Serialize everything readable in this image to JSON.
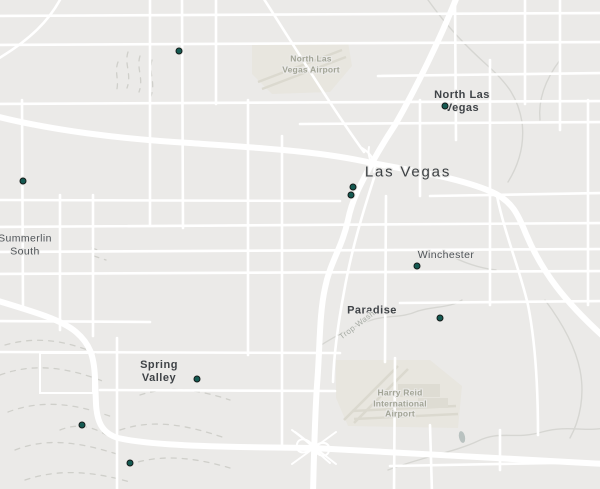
{
  "map": {
    "region": "Las Vegas valley",
    "palette": {
      "background": "#ebeae8",
      "road": "#ffffff",
      "airport_fill": "#e8e6df",
      "runway": "#dbd9cf",
      "terrain_dash": "#cfcfca",
      "wash_line": "#d6d6d2",
      "water": "#b9c2c0",
      "marker_fill": "#155a52",
      "marker_outline": "#141b19",
      "city_label": "#3f4347",
      "poi_label": "#a2a496"
    }
  },
  "labels": [
    {
      "name": "city-label-las-vegas",
      "lines": [
        "Las Vegas"
      ],
      "x": 408,
      "y": 172,
      "type": "city-major"
    },
    {
      "name": "city-label-north-las-vegas",
      "lines": [
        "North Las",
        "Vegas"
      ],
      "x": 462,
      "y": 102,
      "type": "city"
    },
    {
      "name": "city-label-summerlin-south",
      "lines": [
        "Summerlin",
        "South"
      ],
      "x": 25,
      "y": 245,
      "type": "town"
    },
    {
      "name": "city-label-winchester",
      "lines": [
        "Winchester"
      ],
      "x": 446,
      "y": 255,
      "type": "town"
    },
    {
      "name": "city-label-paradise",
      "lines": [
        "Paradise"
      ],
      "x": 372,
      "y": 311,
      "type": "city"
    },
    {
      "name": "city-label-spring-valley",
      "lines": [
        "Spring",
        "Valley"
      ],
      "x": 159,
      "y": 372,
      "type": "city"
    },
    {
      "name": "poi-label-north-las-vegas-airport",
      "lines": [
        "North Las",
        "Vegas Airport"
      ],
      "x": 311,
      "y": 64,
      "type": "poi"
    },
    {
      "name": "poi-label-harry-reid-airport",
      "lines": [
        "Harry Reid",
        "International",
        "Airport"
      ],
      "x": 400,
      "y": 403,
      "type": "poi"
    },
    {
      "name": "waterway-label-trop-wash",
      "lines": [
        "Trop Wash"
      ],
      "x": 357,
      "y": 325,
      "type": "waterway",
      "rotate": -37
    }
  ],
  "markers": [
    {
      "x": 179,
      "y": 51
    },
    {
      "x": 445,
      "y": 106
    },
    {
      "x": 23,
      "y": 181
    },
    {
      "x": 353,
      "y": 187
    },
    {
      "x": 351,
      "y": 195
    },
    {
      "x": 417,
      "y": 266
    },
    {
      "x": 440,
      "y": 318
    },
    {
      "x": 197,
      "y": 379
    },
    {
      "x": 82,
      "y": 425
    },
    {
      "x": 130,
      "y": 463
    }
  ]
}
